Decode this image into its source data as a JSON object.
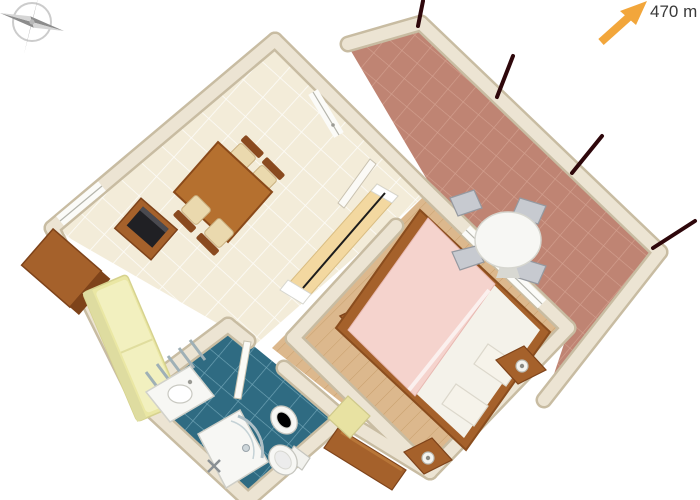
{
  "annotations": {
    "distance_label": "470 m"
  },
  "icons": {
    "compass": "compass-rose",
    "arrow": "north-east-arrow"
  },
  "colors": {
    "wall": "#ece4d3",
    "wall_edge": "#c8bca2",
    "living_tile": "#f3ecd9",
    "living_grout": "#ffffff",
    "terrace_tile": "#bf8473",
    "terrace_grout": "#d3a08f",
    "bath_tile": "#2f6b82",
    "bath_grout": "#71a5b7",
    "wood_floor": "#dcb88d",
    "wood_grain": "#c49a67",
    "furniture_wood": "#a5612b",
    "furniture_wood_dark": "#7e431a",
    "counter": "#f3d8a0",
    "sofa": "#eae7a4",
    "sofa_mattress": "#f2f0bf",
    "duvet": "#f5d3cd",
    "linen": "#f4f2ea",
    "fixture": "#f7f7f4",
    "metal": "#c7cad0",
    "tv": "#202024",
    "arrow": "#f2a63b",
    "railing": "#2e070b",
    "label": "#3a3a3a",
    "compass_light": "#d6d6d6",
    "compass_dark": "#8c8c8c"
  },
  "scene": {
    "railing_tick_count": 4,
    "rooms": [
      {
        "id": "terrace",
        "floor": "terracotta-tile",
        "furniture": [
          "round-table",
          "metal-chairs"
        ]
      },
      {
        "id": "living-room",
        "floor": "cream-tile",
        "furniture": [
          "dining-table",
          "dining-chairs",
          "tv-stand",
          "tv",
          "wardrobe",
          "daybed",
          "kitchenette-counter"
        ]
      },
      {
        "id": "bedroom",
        "floor": "wood-planks",
        "furniture": [
          "double-bed",
          "nightstands",
          "lamps",
          "dresser",
          "stool",
          "cabinet"
        ]
      },
      {
        "id": "bathroom",
        "floor": "blue-tile",
        "furniture": [
          "sink",
          "shower",
          "toilet",
          "bidet",
          "radiator"
        ]
      }
    ]
  }
}
